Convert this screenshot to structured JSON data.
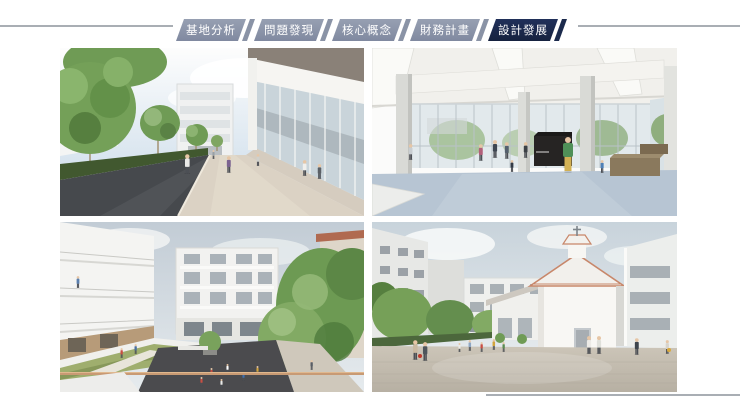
{
  "nav": {
    "tabs": [
      {
        "label": "基地分析",
        "active": false
      },
      {
        "label": "問題發現",
        "active": false
      },
      {
        "label": "核心概念",
        "active": false
      },
      {
        "label": "財務計畫",
        "active": false
      },
      {
        "label": "設計發展",
        "active": true
      }
    ],
    "colors": {
      "inactive": "#8A93A6",
      "active": "#1B2A4C",
      "text": "#FFFFFF",
      "divider": "#A9AEB4"
    }
  },
  "gallery": {
    "images": [
      {
        "alt": "Rendering: tree-lined pedestrian walkway between a white apartment block and a glass-fronted building with people walking"
      },
      {
        "alt": "Rendering: interior of glass pavilion hall with white columns, light blue floor, visitors and an upright piano"
      },
      {
        "alt": "Rendering: courtyard with green roof terrace, sunken dark-paved play plaza and surrounding white apartment buildings"
      },
      {
        "alt": "Rendering: open plaza with white chapel topped by a cross, terracotta roof trim, trees and surrounding housing blocks"
      }
    ]
  }
}
